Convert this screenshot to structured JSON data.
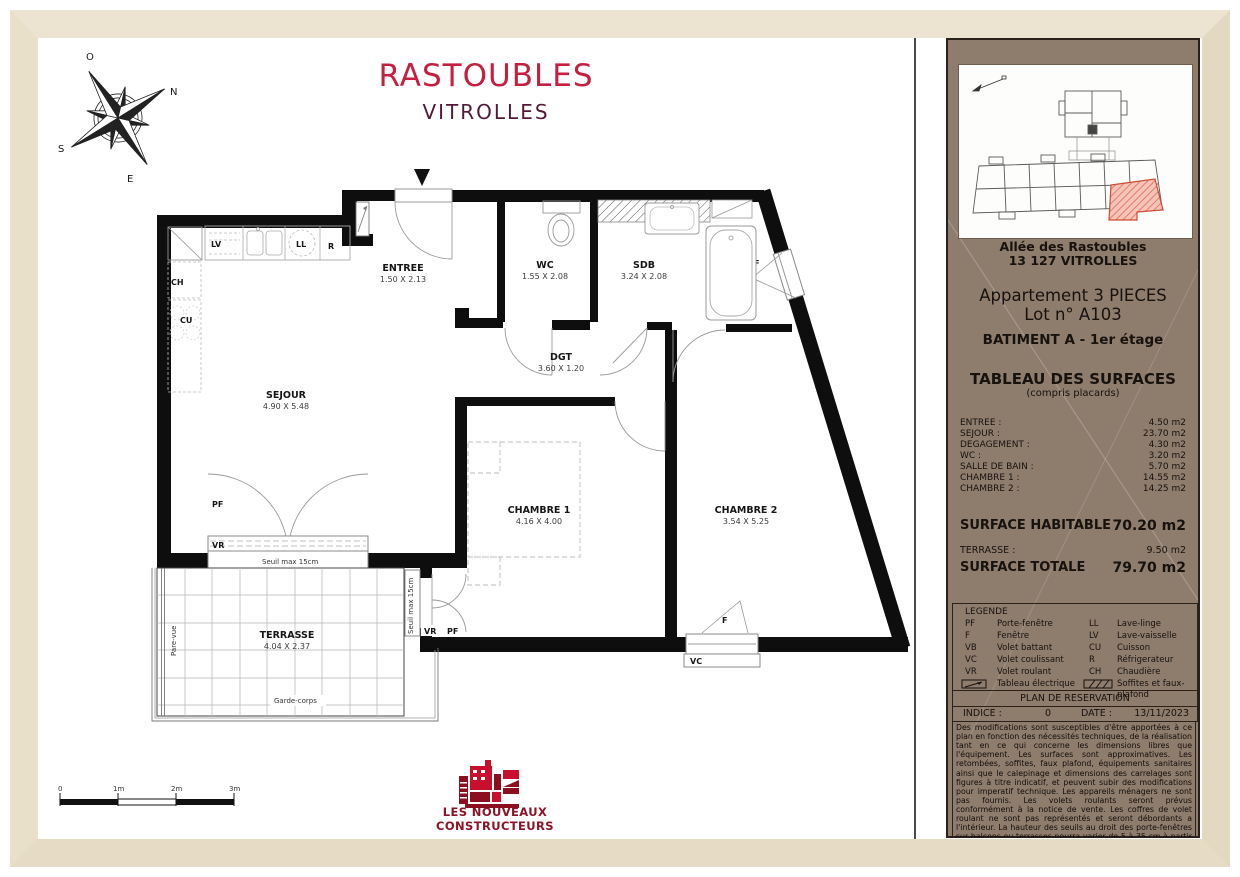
{
  "title": {
    "line1": "RASTOUBLES",
    "line2": "VITROLLES"
  },
  "compass": {
    "n": "N",
    "e": "E",
    "s": "S",
    "o": "O"
  },
  "plan": {
    "rooms": [
      {
        "name": "SEJOUR",
        "dims": "4.90 X 5.48"
      },
      {
        "name": "ENTREE",
        "dims": "1.50 X 2.13"
      },
      {
        "name": "WC",
        "dims": "1.55 X 2.08"
      },
      {
        "name": "SDB",
        "dims": "3.24 X 2.08"
      },
      {
        "name": "DGT",
        "dims": "3.60 X 1.20"
      },
      {
        "name": "CHAMBRE 1",
        "dims": "4.16 X 4.00"
      },
      {
        "name": "CHAMBRE 2",
        "dims": "3.54 X 5.25"
      },
      {
        "name": "TERRASSE",
        "dims": "4.04 X 2.37"
      }
    ],
    "labels": {
      "pf": "PF",
      "vr": "VR",
      "vc": "VC",
      "f": "F",
      "lv": "LV",
      "ll": "LL",
      "r": "R",
      "ch": "CH",
      "cu": "CU",
      "seuil": "Seuil max 15cm",
      "pare_vue": "Pare-vue",
      "garde_corps": "Garde-corps"
    },
    "scale_ticks": [
      "0",
      "1m",
      "2m",
      "3m"
    ]
  },
  "logo": {
    "line1": "LES NOUVEAUX",
    "line2": "CONSTRUCTEURS"
  },
  "sidebar": {
    "address_line1": "Allée des Rastoubles",
    "address_line2": "13 127 VITROLLES",
    "apartment_line1": "Appartement 3 PIECES",
    "apartment_line2": "Lot n° A103",
    "building": "BATIMENT A - 1er étage",
    "surfaces_title": "TABLEAU DES SURFACES",
    "surfaces_subtitle": "(compris placards)",
    "surfaces": [
      {
        "label": "ENTREE :",
        "value": "4.50 m2"
      },
      {
        "label": "SEJOUR :",
        "value": "23.70 m2"
      },
      {
        "label": "DEGAGEMENT :",
        "value": "4.30 m2"
      },
      {
        "label": "WC :",
        "value": "3.20 m2"
      },
      {
        "label": "SALLE DE BAIN :",
        "value": "5.70 m2"
      },
      {
        "label": "CHAMBRE 1 :",
        "value": "14.55 m2"
      },
      {
        "label": "CHAMBRE 2 :",
        "value": "14.25 m2"
      }
    ],
    "habitable_label": "SURFACE HABITABLE",
    "habitable_value": "70.20 m2",
    "terrasse_label": "TERRASSE :",
    "terrasse_value": "9.50 m2",
    "totale_label": "SURFACE TOTALE",
    "totale_value": "79.70 m2",
    "legend": {
      "title": "LEGENDE",
      "items_left": [
        {
          "abbr": "PF",
          "label": "Porte-fenêtre"
        },
        {
          "abbr": "F",
          "label": "Fenêtre"
        },
        {
          "abbr": "VB",
          "label": "Volet battant"
        },
        {
          "abbr": "VC",
          "label": "Volet coulissant"
        },
        {
          "abbr": "VR",
          "label": "Volet roulant"
        }
      ],
      "items_right": [
        {
          "abbr": "LL",
          "label": "Lave-linge"
        },
        {
          "abbr": "LV",
          "label": "Lave-vaisselle"
        },
        {
          "abbr": "CU",
          "label": "Cuisson"
        },
        {
          "abbr": "R",
          "label": "Réfrigerateur"
        },
        {
          "abbr": "CH",
          "label": "Chaudière"
        }
      ],
      "elec_label": "Tableau électrique",
      "soffites_label": "Soffites et faux-plafond"
    },
    "reservation": "PLAN DE RESERVATION",
    "indice_label": "INDICE :",
    "indice_value": "0",
    "date_label": "DATE :",
    "date_value": "13/11/2023",
    "disclaimer": "Des modifications sont susceptibles d'être apportées à ce plan en fonction des nécessités techniques, de la réalisation tant en ce qui concerne les dimensions libres que l'équipement. Les surfaces sont approximatives. Les retombées, soffites, faux plafond, équipements sanitaires ainsi que le calepinage et dimensions des carrelages sont figures à titre indicatif, et peuvent subir des modifications pour imperatif technique. Les appareils ménagers ne sont pas fournis. Les volets roulants seront prévus conformément à la notice de vente. Les coffres de volet roulant ne sont pas représentés et seront débordants a l'intérieur. La hauteur des seuils au droit des porte-fenêtres sur balcons ou terrasses pourra varier de 5 à 35 cm à partir du sol intérieur. La hauteur entre le jardin et la terrasse pourra varier entre 0 et 60 cm. Les jardins ne seront pas nécessairement plats et pourront comporter des talus et des pentes."
  }
}
